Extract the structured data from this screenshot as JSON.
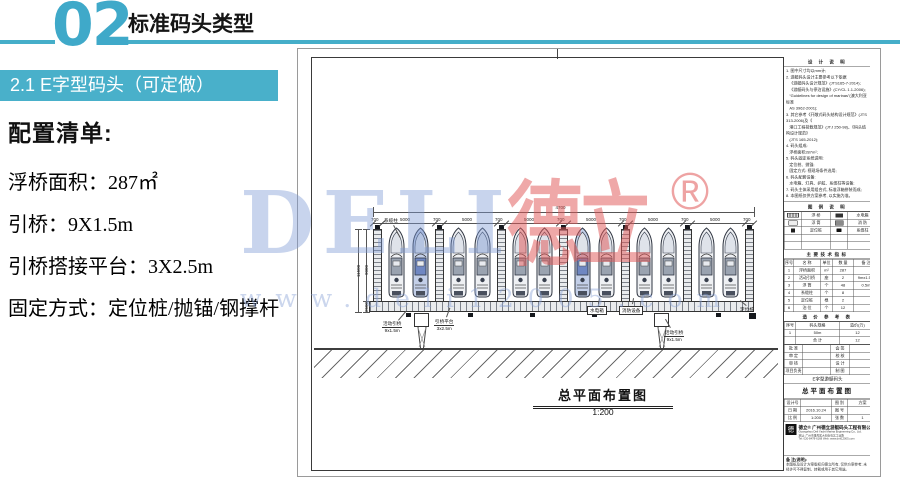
{
  "slide": {
    "accent_color": "#45AEC9",
    "section_number": "02",
    "section_title": "标准码头类型",
    "subsection_title": "2.1 E字型码头（可定做）",
    "config": {
      "heading": "配置清单:",
      "items": [
        {
          "label": "浮桥面积：",
          "value": "287㎡"
        },
        {
          "label": "引桥：",
          "value": "9X1.5m"
        },
        {
          "label": "引桥搭接平台：",
          "value": "3X2.5m"
        },
        {
          "label": "固定方式：",
          "value": "定位桩/抛锚/钢撑杆"
        }
      ]
    }
  },
  "watermark": {
    "brand_latin": "DELI",
    "brand_cjk": "德立",
    "registered": "®",
    "url": "www.deli12005.com",
    "blue": "#7D99D4",
    "red": "#E05858"
  },
  "drawing": {
    "title": "总平面布置图",
    "scale": "1:200",
    "overall_dim": "4700",
    "bay_dim": "5000",
    "finger_dim": "700",
    "side_dims": {
      "outer": "11500",
      "boat": "9000",
      "walkway": "2500"
    },
    "berth_count": 12,
    "finger_count": 7,
    "labels": {
      "mooring_post": "系缆柱",
      "gangway_left": "活动引桥",
      "gangway_left_size": "9x1.5m",
      "platform": "引桥平台",
      "platform_size": "3x2.5m",
      "utility_box": "水电箱",
      "fire_equipment": "消防设备",
      "gangway_right": "活动引桥",
      "gangway_right_size": "9x1.5m",
      "positioning_pile": "定位桩"
    }
  },
  "titleblock": {
    "notes_title": "设 计 说 明",
    "notes": [
      "1. 图中尺寸均以mm计;",
      "2. 游艇码头设计主要参考以下依据",
      "   《游艇码头设计规范》(JTS165-7-2014);",
      "   《游艇码头与停泊设施》(CY/CL 1.1-2006);",
      "   “Guidelines for design of marinas”(澳大利亚标准",
      "   AS 3962-2001);",
      "3. 其它参考《开敞式码头结构设计规范》(JTS 313-2006)及《",
      "   港口工程荷载规范》(JTJ 250-98)、《码头结构设计规范》",
      "   (JTS 165-2012);",
      "4. 码头组成:",
      "   浮桥面积287m²;",
      "5. 码头固定系统说明:",
      "   定位桩、抛锚;",
      "   固定方式: 视现场条件选用;",
      "6. 码头配套设备:",
      "   水电箱、灯具、护舷、系缆柱等设备;",
      "7. 码头主体采用组合式, 标准浮箱拼装而成;",
      "8. 本图纸仅供方案参考, 以实施为准。"
    ],
    "legend_title": "图 例 说 明",
    "legend_rows": [
      {
        "sym1": "sym-dock",
        "name1": "浮 桥",
        "sym2": "sym-box",
        "name2": "水电箱"
      },
      {
        "sym1": "sym-pontoon",
        "name1": "浮 筒",
        "sym2": "sym-fire",
        "name2": "消 防"
      },
      {
        "sym1": "sym-pile",
        "name1": "定位桩",
        "sym2": "sym-cleat",
        "name2": "系缆柱"
      }
    ],
    "tech_title": "主要技术指标",
    "tech_headers": [
      "序号",
      "名 称",
      "单位",
      "数 量",
      "备 注"
    ],
    "tech_rows": [
      [
        "1",
        "浮桥面积",
        "m²",
        "287",
        ""
      ],
      [
        "2",
        "活动引桥",
        "座",
        "2",
        "9mx1.5m"
      ],
      [
        "3",
        "浮 筒",
        "个",
        "48",
        "0.5m"
      ],
      [
        "4",
        "系缆柱",
        "个",
        "8",
        ""
      ],
      [
        "5",
        "定位桩",
        "根",
        "2",
        ""
      ],
      [
        "6",
        "泊 位",
        "个",
        "12",
        ""
      ]
    ],
    "price_title": "造 价 参 考 表",
    "price_headers": [
      "序号",
      "码头规格",
      "造价(万)"
    ],
    "price_rows": [
      [
        "1",
        "50m",
        "12"
      ],
      [
        "",
        "合 计",
        "12"
      ]
    ],
    "sign_rows": [
      [
        "批 准",
        "",
        "会 签",
        ""
      ],
      [
        "审 定",
        "",
        "校 核",
        ""
      ],
      [
        "审 核",
        "",
        "设 计",
        ""
      ],
      [
        "项目负责",
        "",
        "制 图",
        ""
      ]
    ],
    "project_name": "E字型游艇码头",
    "drawing_name": "总平面布置图",
    "meta_rows": [
      [
        "设计号",
        "",
        "图 别",
        "方案"
      ],
      [
        "日 期",
        "2016.10.24",
        "图 号",
        ""
      ],
      [
        "比 例",
        "1:200",
        "张 数",
        "1"
      ]
    ],
    "logo_glyph": "德",
    "brand": "德立®",
    "company_cn": "广州德立游艇码头工程有限公司",
    "company_en": "Guangzhou Deli Yacht Marina Engineering Co., Ltd.",
    "addr1": "地址: 广州市番禺区大石街石北工业路",
    "addr2": "Tel: 020-8478-6168   Web: www.deli12005.com",
    "note_title": "备 注(说明):",
    "note_text": "本图纸及设计方案版权归德立所有, 仅供方案参考; 未经许可不得复制、转载或用于其它用途。"
  }
}
